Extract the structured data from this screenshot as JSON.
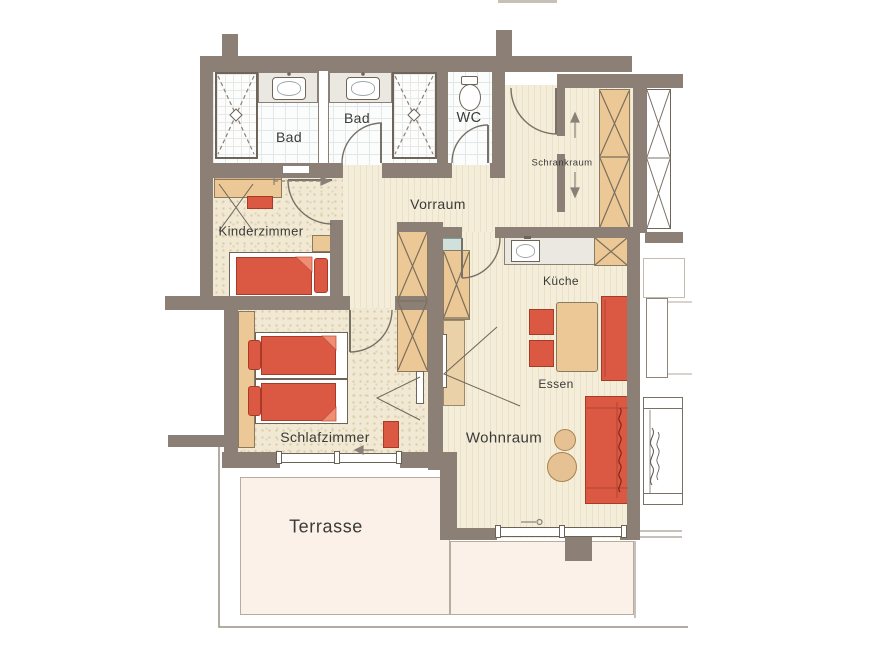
{
  "rooms": {
    "bad1": {
      "label": "Bad"
    },
    "bad2": {
      "label": "Bad"
    },
    "wc": {
      "label": "WC"
    },
    "schrankraum": {
      "label": "Schrankraum"
    },
    "vorraum": {
      "label": "Vorraum"
    },
    "kinderzimmer": {
      "label": "Kinderzimmer"
    },
    "kueche": {
      "label": "Küche"
    },
    "essen": {
      "label": "Essen"
    },
    "schlafzimmer": {
      "label": "Schlafzimmer"
    },
    "wohnraum": {
      "label": "Wohnraum"
    },
    "terrasse": {
      "label": "Terrasse"
    }
  },
  "colors": {
    "wall": "#8c8076",
    "furniture_red": "#db5843",
    "furniture_wood": "#ecc897",
    "floor_cream": "#f3ecd9",
    "floor_tile": "#fbfcfc",
    "terrace": "#fbf1e8",
    "glass_blue": "#cfe0dd"
  }
}
